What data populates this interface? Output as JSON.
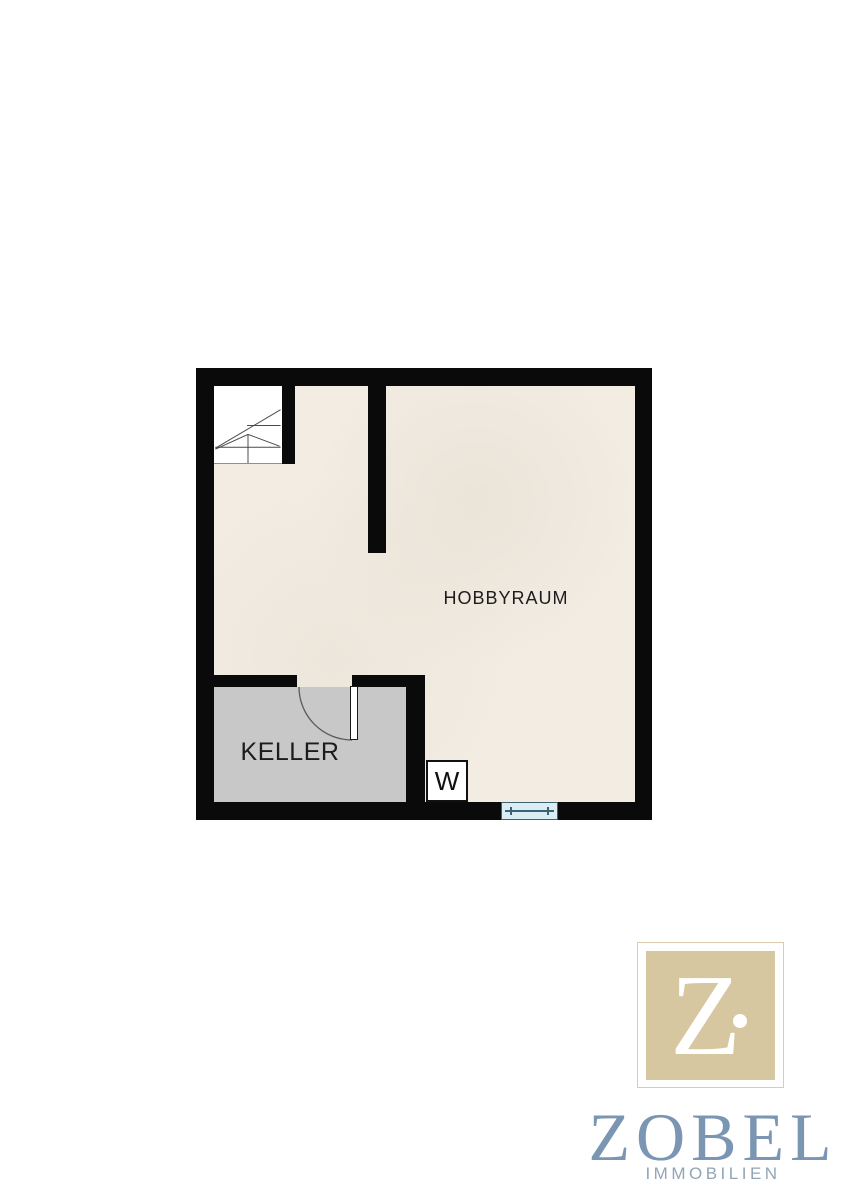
{
  "plan": {
    "rooms": {
      "hobbyraum": {
        "label": "HOBBYRAUM"
      },
      "keller": {
        "label": "KELLER"
      }
    },
    "washer": {
      "label": "W"
    },
    "icons": {
      "stairs": "stairs-icon",
      "door_swing": "door-swing-icon",
      "window": "window-icon"
    }
  },
  "logo": {
    "monogram": "Z",
    "name": "ZOBEL",
    "subtitle": "IMMOBILIEN"
  },
  "colors": {
    "wall": "#0a0a0a",
    "floor": "#f2ece3",
    "keller_floor": "#c8c8c8",
    "window_fill": "#d9eef4",
    "window_line": "#3e6270",
    "logo_tan": "#d7c7a0",
    "logo_frame": "#dacdaa",
    "logo_blue": "#7b96b3",
    "logo_gray": "#92a5b5",
    "label_ink": "#1c1c1c"
  }
}
